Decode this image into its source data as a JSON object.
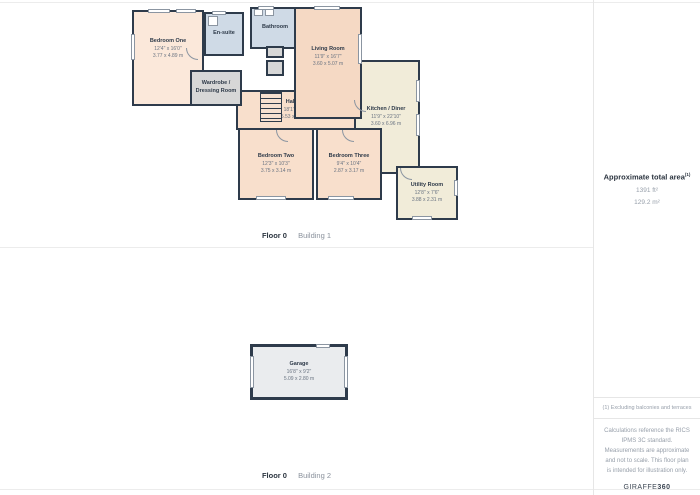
{
  "colors": {
    "wall": "#2e3b4b",
    "room_peach": "#f8dfcc",
    "room_peach_light": "#fbe8da",
    "room_peach_deep": "#f5d9c4",
    "room_blue": "#cfdae6",
    "room_cream": "#f1ecd9",
    "room_grey": "#d7d7d7",
    "garage_fill": "#eaecee"
  },
  "floors": [
    {
      "floor_label": "Floor 0",
      "building_label": "Building 1",
      "rooms": [
        {
          "name": "Bedroom One",
          "imperial": "12'4\" x 16'0\"",
          "metric": "3.77 x 4.89 m"
        },
        {
          "name": "En-suite",
          "imperial": "",
          "metric": ""
        },
        {
          "name": "Bathroom",
          "imperial": "",
          "metric": ""
        },
        {
          "name": "Living Room",
          "imperial": "11'9\" x 16'7\"",
          "metric": "3.60 x 5.07 m"
        },
        {
          "name": "Wardrobe / Dressing Room",
          "imperial": "",
          "metric": ""
        },
        {
          "name": "Hallway",
          "imperial": "18'1\" x 4'2\"",
          "metric": "5.53 x 1.29 m"
        },
        {
          "name": "Kitchen / Diner",
          "imperial": "11'9\" x 22'10\"",
          "metric": "3.60 x 6.96 m"
        },
        {
          "name": "Bedroom Two",
          "imperial": "12'3\" x 10'3\"",
          "metric": "3.75 x 3.14 m"
        },
        {
          "name": "Bedroom Three",
          "imperial": "9'4\" x 10'4\"",
          "metric": "2.87 x 3.17 m"
        },
        {
          "name": "Utility Room",
          "imperial": "12'8\" x 7'6\"",
          "metric": "3.88 x 2.31 m"
        }
      ]
    },
    {
      "floor_label": "Floor 0",
      "building_label": "Building 2",
      "rooms": [
        {
          "name": "Garage",
          "imperial": "16'8\" x 9'2\"",
          "metric": "5.09 x 2.80 m"
        }
      ]
    }
  ],
  "sidebar": {
    "total_area_title": "Approximate total area",
    "total_area_footnote_marker": "(1)",
    "total_area_ft": "1391 ft²",
    "total_area_m": "129.2 m²",
    "footnote": "(1) Excluding balconies and terraces",
    "disclaimer": "Calculations reference the RICS IPMS 3C standard. Measurements are approximate and not to scale. This floor plan is intended for illustration only.",
    "brand_prefix": "GIRAFFE",
    "brand_suffix": "360"
  }
}
